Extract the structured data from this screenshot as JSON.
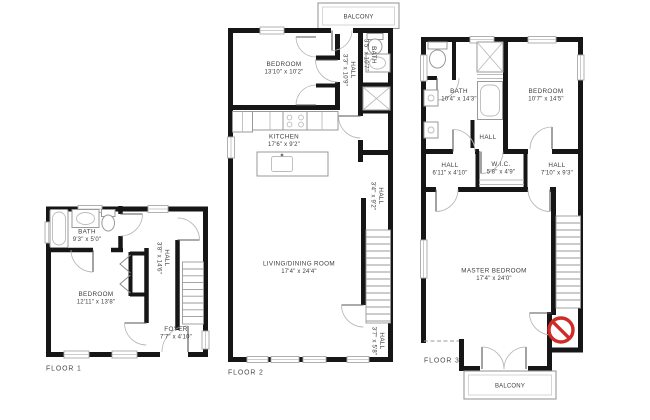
{
  "colors": {
    "background": "#ffffff",
    "wall": "#161616",
    "label_text": "#3d3d3d",
    "fixture_line": "#999999",
    "no_entry_red": "#d02b27"
  },
  "floor1": {
    "label": "FLOOR 1",
    "bath": {
      "name": "BATH",
      "dims": "9'3\" x 5'0\""
    },
    "bedroom": {
      "name": "BEDROOM",
      "dims": "12'11\" x 13'8\""
    },
    "hall": {
      "name": "HALL",
      "dims": "3'8\" x 14'6\""
    },
    "foyer": {
      "name": "FOYER",
      "dims": "7'7\" x 4'10\""
    }
  },
  "floor2": {
    "label": "FLOOR 2",
    "balcony": {
      "name": "BALCONY"
    },
    "bedroom": {
      "name": "BEDROOM",
      "dims": "13'10\" x 10'2\""
    },
    "hall_upper": {
      "name": "HALL",
      "dims": "3'3\" x 10'9\""
    },
    "bath": {
      "name": "BATH",
      "dims": "3'5\" x 10'7\""
    },
    "kitchen": {
      "name": "KITCHEN",
      "dims": "17'6\" x 9'2\""
    },
    "hall_mid": {
      "name": "HALL",
      "dims": "3'4\" x 9'2\""
    },
    "living": {
      "name": "LIVING/DINING ROOM",
      "dims": "17'4\" x 24'4\""
    },
    "hall_lower": {
      "name": "HALL",
      "dims": "3'7\" x 5'8\""
    }
  },
  "floor3": {
    "label": "FLOOR 3",
    "balcony": {
      "name": "BALCONY"
    },
    "bath": {
      "name": "BATH",
      "dims": "10'4\" x 14'3\""
    },
    "bedroom": {
      "name": "BEDROOM",
      "dims": "10'7\" x 14'5\""
    },
    "hall_top": {
      "name": "HALL"
    },
    "hall_left": {
      "name": "HALL",
      "dims": "6'11\" x 4'10\""
    },
    "wic": {
      "name": "W.I.C.",
      "dims": "5'8\" x 4'9\""
    },
    "hall_right": {
      "name": "HALL",
      "dims": "7'10\" x 9'3\""
    },
    "master": {
      "name": "MASTER BEDROOM",
      "dims": "17'4\" x 24'0\""
    }
  }
}
